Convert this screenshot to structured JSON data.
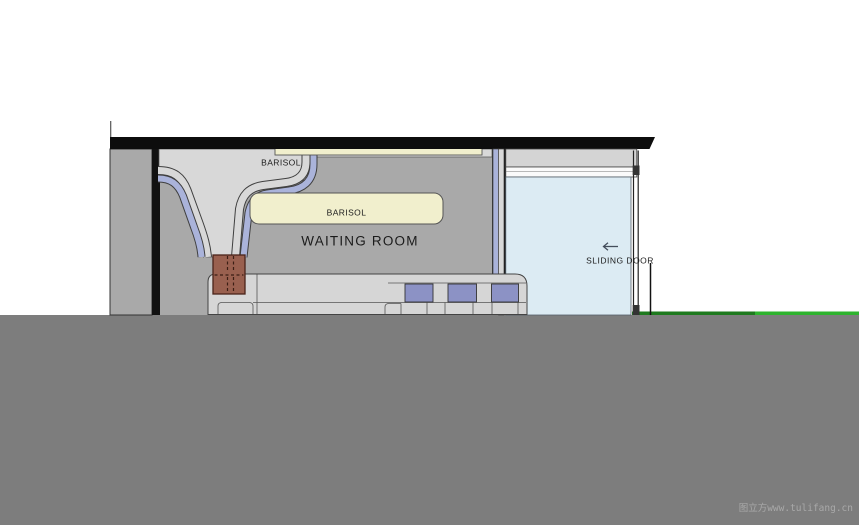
{
  "page": {
    "watermark": "图立方www.tulifang.cn"
  },
  "labels": {
    "barisol_top": "BARISOL",
    "barisol_panel": "BARISOL",
    "room_title": "WAITING ROOM",
    "sliding_door": "SLIDING DOOR"
  },
  "colors": {
    "roof": "#0d0d0d",
    "wall_dark": "#111111",
    "masonry_gray": "#a9a9a9",
    "ceiling_light": "#d8d8d8",
    "ribbon_gray": "#d8d8d8",
    "ribbon_blue": "#aab3da",
    "barisol_cream": "#f1efcd",
    "planter_brown": "#99604f",
    "planter_outline": "#4a241a",
    "bench_gray": "#d6d6d6",
    "cushion_purple": "#8c92c5",
    "glass_blue": "#dcebf3",
    "frame_gray": "#d4d4d4",
    "track_white": "#fafafa",
    "lawn_green_dark": "#1e7a1e",
    "lawn_green": "#2eb32e",
    "ground_gray": "#7d7d7d",
    "outline": "#3f3f3f",
    "text_dark": "#1b1b1b",
    "watermark_gray": "#a9a9a9"
  }
}
